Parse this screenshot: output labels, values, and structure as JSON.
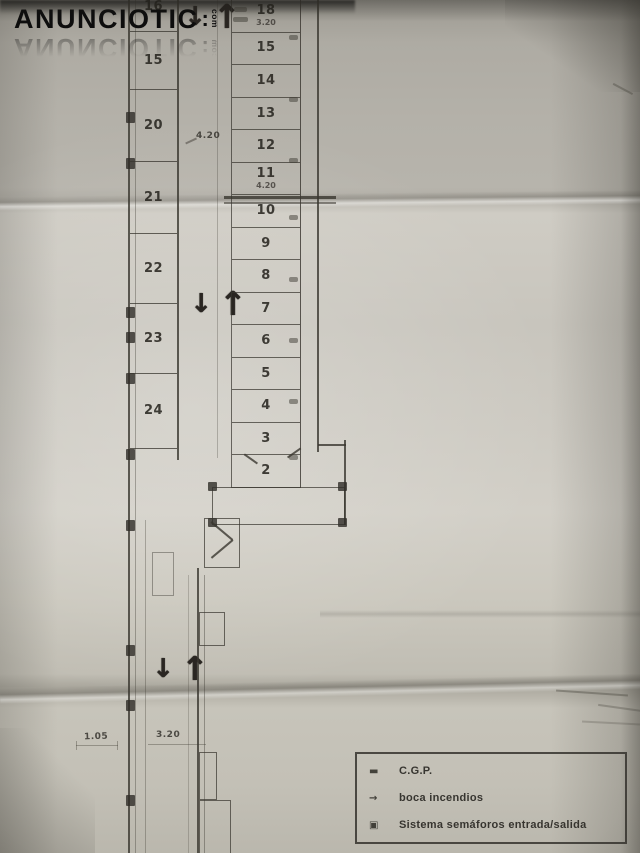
{
  "watermark": {
    "main": "ANUNCIOTIC",
    "dot": ":",
    "suffix": "com"
  },
  "plan": {
    "arrows": {
      "down": "↓",
      "up": "↑"
    },
    "left_column": {
      "stalls": [
        {
          "label": "16"
        },
        {
          "label": "15"
        },
        {
          "label": "20"
        },
        {
          "label": "21"
        },
        {
          "label": "22"
        },
        {
          "label": "23"
        },
        {
          "label": "24"
        }
      ]
    },
    "right_column": {
      "stalls": [
        {
          "label": "18",
          "sub": "3.20"
        },
        {
          "label": "15"
        },
        {
          "label": "14"
        },
        {
          "label": "13"
        },
        {
          "label": "12"
        },
        {
          "label": "11",
          "sub": "4.20"
        },
        {
          "label": "10"
        },
        {
          "label": "9"
        },
        {
          "label": "8"
        },
        {
          "label": "7"
        },
        {
          "label": "6"
        },
        {
          "label": "5"
        },
        {
          "label": "4"
        },
        {
          "label": "3"
        },
        {
          "label": "2"
        }
      ]
    },
    "dims": {
      "aisle": "4.20",
      "corridor_left": "1.05",
      "corridor_right": "3.20"
    }
  },
  "legend": {
    "items": [
      {
        "symbol": "▬",
        "label": "C.G.P."
      },
      {
        "symbol": "→",
        "label": "boca incendios"
      },
      {
        "symbol": "▣",
        "label": "Sistema semáforos entrada/salida"
      }
    ]
  }
}
